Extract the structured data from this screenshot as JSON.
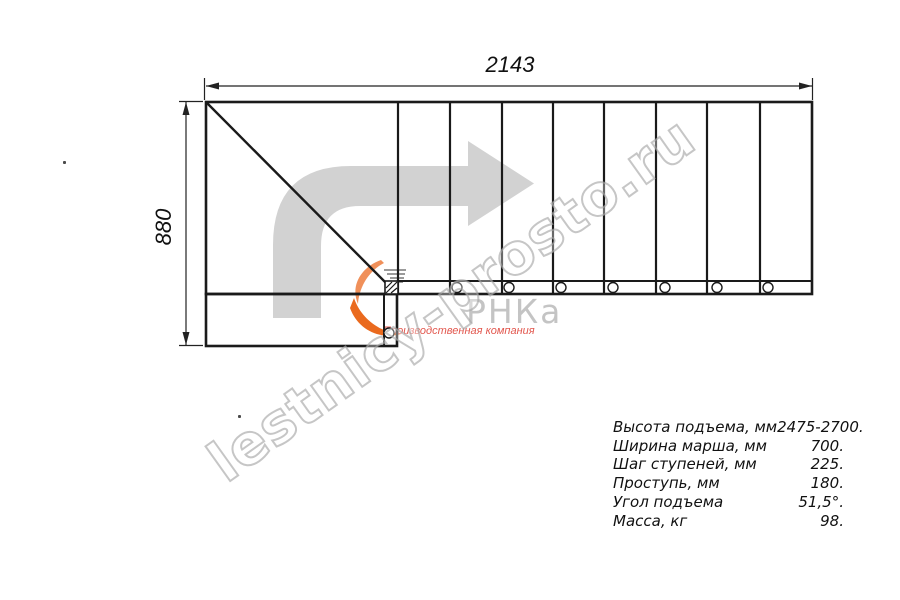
{
  "drawing": {
    "width_dim": "2143",
    "height_dim": "880"
  },
  "specs": {
    "rows": [
      {
        "label": "Высота подъема, мм",
        "value": "2475-2700."
      },
      {
        "label": "Ширина марша, мм",
        "value": "700."
      },
      {
        "label": "Шаг ступеней, мм",
        "value": "225."
      },
      {
        "label": "Проступь, мм",
        "value": "180."
      },
      {
        "label": "Угол подъема",
        "value": "51,5°."
      },
      {
        "label": "Масса, кг",
        "value": "98."
      }
    ]
  },
  "watermark": {
    "text": "lestnicy-prosto.ru"
  },
  "logo": {
    "name": "РНКа",
    "tagline": "Производственная компания"
  },
  "icons": {
    "direction_arrow": "turn-right-arrow-icon",
    "swoosh": "logo-swoosh-icon"
  },
  "colors": {
    "line": "#1a1a1a",
    "arrow_gray": "#d2d2d2",
    "accent_orange": "#ea6a1e",
    "tagline_red": "#e2574e",
    "watermark_gray": "#a8a8a8"
  }
}
